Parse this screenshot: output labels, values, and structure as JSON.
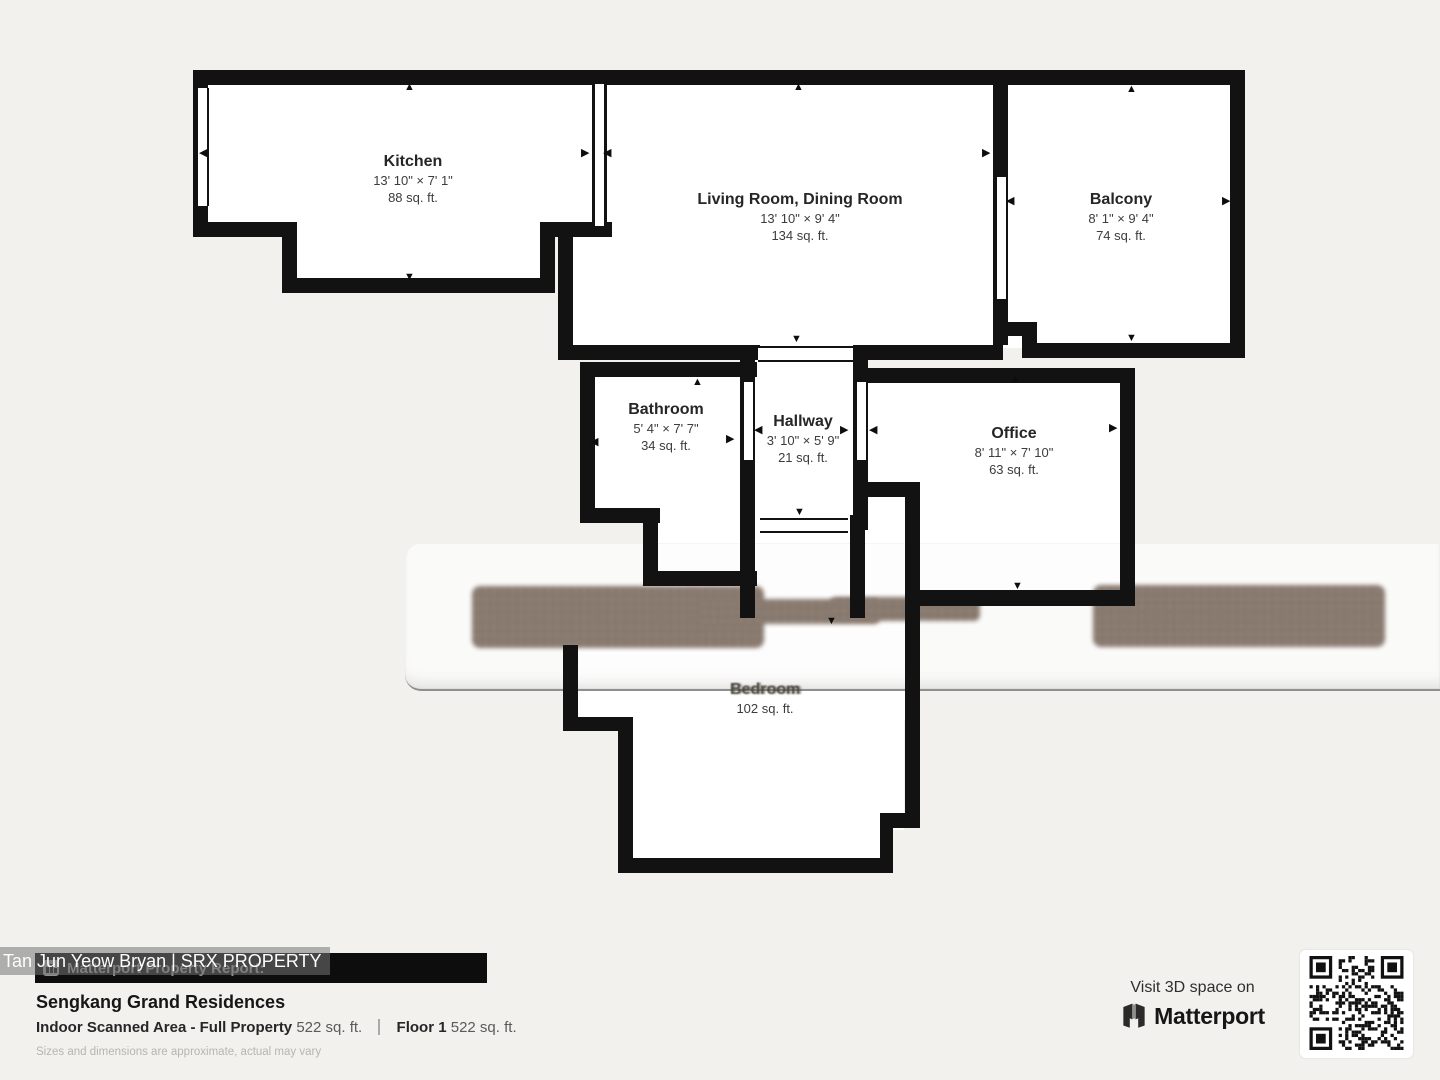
{
  "floorplan": {
    "rooms": [
      {
        "id": "kitchen",
        "name": "Kitchen",
        "dims": "13' 10\" × 7' 1\"",
        "area": "88 sq. ft."
      },
      {
        "id": "living",
        "name": "Living Room, Dining Room",
        "dims": "13' 10\" × 9' 4\"",
        "area": "134 sq. ft."
      },
      {
        "id": "balcony",
        "name": "Balcony",
        "dims": "8' 1\" × 9' 4\"",
        "area": "74 sq. ft."
      },
      {
        "id": "bathroom",
        "name": "Bathroom",
        "dims": "5' 4\" × 7' 7\"",
        "area": "34 sq. ft."
      },
      {
        "id": "hallway",
        "name": "Hallway",
        "dims": "3' 10\" × 5' 9\"",
        "area": "21 sq. ft."
      },
      {
        "id": "office",
        "name": "Office",
        "dims": "8' 11\" × 7' 10\"",
        "area": "63 sq. ft."
      },
      {
        "id": "bedroom",
        "name": "Bedroom",
        "dims": "",
        "area": "102 sq. ft."
      }
    ]
  },
  "watermark": {
    "text": "Tan Jun Yeow Bryan | SRX PROPERTY"
  },
  "report": {
    "bar_title": "Matterport Property Report:",
    "property_name": "Sengkang Grand Residences",
    "scanned_label": "Indoor Scanned Area - Full Property",
    "scanned_value": "522 sq. ft.",
    "floor_label": "Floor 1",
    "floor_value": "522 sq. ft.",
    "disclaimer": "Sizes and dimensions are approximate, actual may vary"
  },
  "cta": {
    "line1": "Visit 3D space on",
    "brand": "Matterport"
  },
  "colors": {
    "wall": "#121212",
    "blur_brown": "#8a7b70",
    "bar_bg": "#0d0d0d",
    "page_bg": "#f2f1ee"
  }
}
